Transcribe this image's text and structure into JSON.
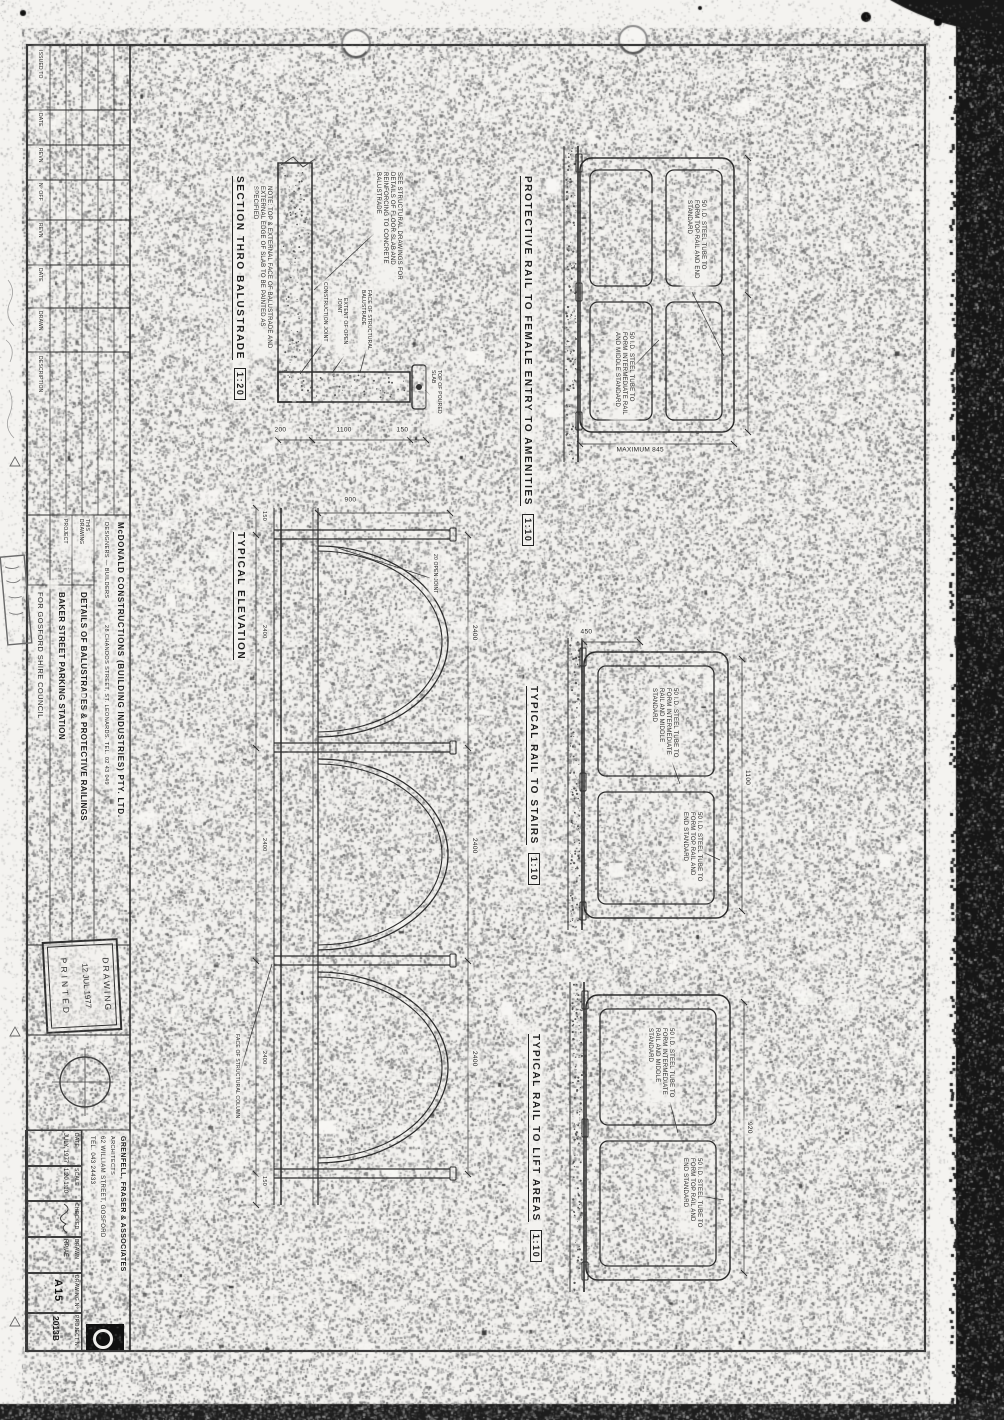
{
  "drawings": {
    "rail_amenities": {
      "title": "PROTECTIVE RAIL TO FEMALE ENTRY TO AMENITIES",
      "scale": "1:10"
    },
    "rail_stairs": {
      "title": "TYPICAL RAIL TO STAIRS",
      "scale": "1:10"
    },
    "rail_lift": {
      "title": "TYPICAL RAIL TO LIFT AREAS",
      "scale": "1:10"
    },
    "section": {
      "title": "SECTION  THRO  BALUSTRADE",
      "scale": "1:20"
    },
    "elevation": {
      "title": "TYPICAL  ELEVATION"
    }
  },
  "notes": {
    "structural": "SEE STRUCTURAL DRAWINGS FOR DETAILS OF FLOOR SLAB AND REINFORCING TO CONCRETE BALUSTRADE",
    "painting": "NOTE: TOP & EXTERNAL FACE OF BALUSTRADE AND EXTERNAL EDGE OF SLAB TO BE PAINTED AS SPECIFIED",
    "open_joint": "20 OPEN JOINT",
    "extent_open_joint": "EXTENT OF OPEN JOINT",
    "construction_joint": "CONSTRUCTION JOINT",
    "face_balustrade": "FACE OF STRUCTURAL BALUSTRADE",
    "top_of_slab": "TOP OF POURED SLAB",
    "face_column": "FACE OF STRUCTURAL COLUMN",
    "tube_top_rail": "50 I.D. STEEL TUBE TO FORM TOP RAIL AND END STANDARD",
    "tube_mid_rail": "50 I.D. STEEL TUBE TO FORM INTERMEDIATE RAIL AND MIDDLE STANDARD"
  },
  "dims": {
    "amenities_height": "MAXIMUM 845",
    "stairs_width": "1100",
    "stairs_left": "450",
    "lift_width": "920",
    "section_chain": [
      "150",
      "1100",
      "200"
    ],
    "elevation_top": [
      "2400",
      "2400",
      "2400"
    ],
    "elevation_bottom": [
      "150",
      "2400",
      "2400",
      "2400",
      "150"
    ],
    "elevation_height": "900"
  },
  "stamp": {
    "line1": "DRAWING",
    "line2": "12 JUL 1977",
    "line3": "PRINTED"
  },
  "revision_table": {
    "headers": [
      "ISSUED TO",
      "DATE",
      "REVN",
      "Nº OFF",
      "REVN",
      "DATE",
      "DRAWN",
      "DESCRIPTION"
    ]
  },
  "title_block": {
    "builder_name": "McDONALD  CONSTRUCTIONS  (BUILDING  INDUSTRIES)  PTY. LTD.",
    "builder_role": "DESIGNERS — BUILDERS",
    "builder_address": "28 CHANDOS STREET, ST. LEONARDS.   TEL. 02  43 049",
    "this_drawing_label": "THIS DRAWING",
    "project_label": "PROJECT",
    "drawing_title": "DETAILS  OF  BALUSTRADES  &  PROTECTIVE  RAILINGS",
    "project_title": "BAKER  STREET  PARKING  STATION",
    "client": "FOR  GOSFORD  SHIRE  COUNCIL",
    "date_label": "DATE",
    "date_value": "JULY, 1977",
    "scale_label": "SCALE",
    "scale_value": "1:20   1:10",
    "checked_label": "CHECKED",
    "drawn_label": "DRAWN",
    "drawn_value": "RP/AE",
    "architect_name": "GRENFELL, FRASER & ASSOCIATES",
    "architect_role": "ARCHITECTS",
    "architect_address": "62 WILLIAM STREET, GOSFORD",
    "architect_tel": "TEL. 043  24433",
    "drawing_no_label": "DRAWING Nº",
    "drawing_no": "A15",
    "project_no_label": "PROJECT Nº",
    "project_no": "2013B"
  }
}
